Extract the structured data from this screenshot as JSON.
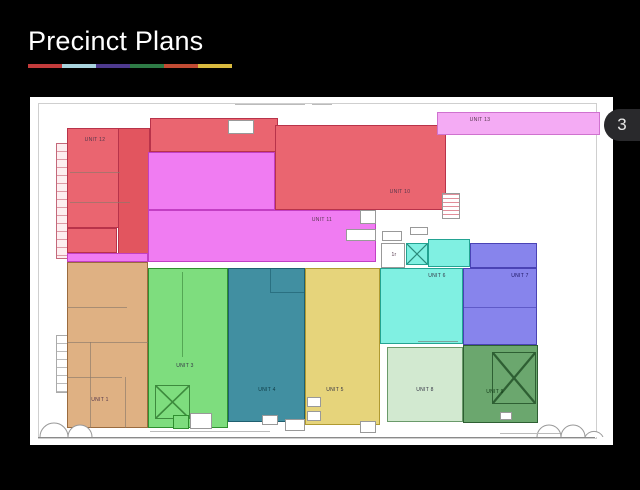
{
  "slide": {
    "title": "Precinct Plans",
    "page_badge": "3",
    "accent_bar_colors": [
      "#c23b3b",
      "#a9d3dd",
      "#4e3a8e",
      "#2e7b46",
      "#c14b33",
      "#d9ba3f"
    ],
    "background_color": "#000000"
  },
  "plan": {
    "canvas_color": "#ffffff",
    "units": [
      {
        "key": "unit-12",
        "label": "UNIT 12",
        "color": "#ea6570"
      },
      {
        "key": "unit-10",
        "label": "UNIT 10",
        "color": "#ea6570"
      },
      {
        "key": "unit-11",
        "label": "UNIT 11",
        "color": "#f07cf2"
      },
      {
        "key": "unit-13",
        "label": "UNIT 13",
        "color": "#f4abf4"
      },
      {
        "key": "unit-1",
        "label": "UNIT 1",
        "color": "#dfb183"
      },
      {
        "key": "unit-3",
        "label": "UNIT 3",
        "color": "#7edd7e"
      },
      {
        "key": "unit-4",
        "label": "UNIT 4",
        "color": "#418fa1"
      },
      {
        "key": "unit-5",
        "label": "UNIT 5",
        "color": "#e6d47b"
      },
      {
        "key": "unit-6",
        "label": "UNIT 6",
        "color": "#80f0e2"
      },
      {
        "key": "unit-7",
        "label": "UNIT 7",
        "color": "#8784ec"
      },
      {
        "key": "unit-8",
        "label": "UNIT 8",
        "color": "#d2e9d0"
      },
      {
        "key": "unit-9",
        "label": "UNIT 9",
        "color": "#6ba76e"
      },
      {
        "key": "stair-room",
        "label": "1r",
        "color": "#ffffff"
      }
    ]
  }
}
